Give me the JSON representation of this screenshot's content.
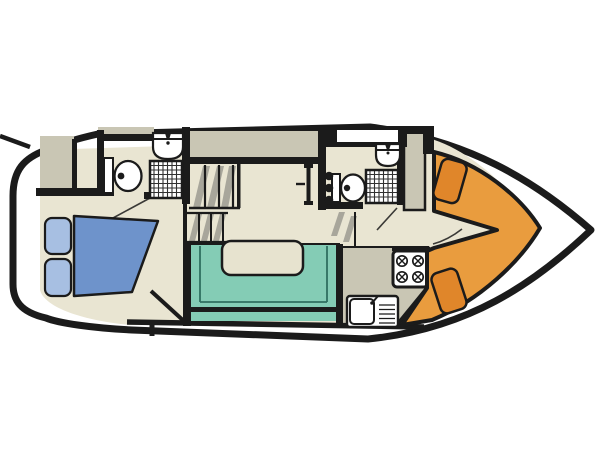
{
  "meta": {
    "diagram_type": "boat-deck-floor-plan",
    "view": "top-down",
    "bow_direction": "right"
  },
  "colors": {
    "outline": "#1b1b1b",
    "hull_white": "#ffffff",
    "floor_cream": "#e9e5d2",
    "deck_taupe": "#c9c6b4",
    "dinette_teal": "#84ccb5",
    "dinette_teal_dark": "#2f6f5f",
    "table_cream": "#e7e3cf",
    "bed_blue": "#6e93cb",
    "pillow_blue": "#a7bfe2",
    "cockpit_orange": "#e99c3e",
    "seat_orange": "#e0862a",
    "steps_gray": "#a8a69b",
    "fixture_white": "#ffffff"
  },
  "areas": {
    "swim_platform": {
      "position": "stern-left"
    },
    "aft_cabin": {
      "furniture": [
        "double-bed",
        "two-pillows",
        "wardrobe"
      ]
    },
    "bathroom_aft": {
      "fixtures": [
        "toilet",
        "washbasin",
        "shower-tray"
      ]
    },
    "companionway": {
      "step_flights": 3
    },
    "saloon_dinette": {
      "furniture": [
        "u-shaped-bench",
        "table"
      ]
    },
    "bathroom_forward": {
      "fixtures": [
        "toilet",
        "washbasin",
        "shower-tray",
        "skylight-hatch"
      ]
    },
    "galley": {
      "fixtures": [
        "four-burner-hob",
        "sink-with-drainer"
      ],
      "burner_count": 4
    },
    "bow_cockpit": {
      "furniture": [
        "helm-seat",
        "helm-seat"
      ],
      "seat_count": 2
    }
  }
}
